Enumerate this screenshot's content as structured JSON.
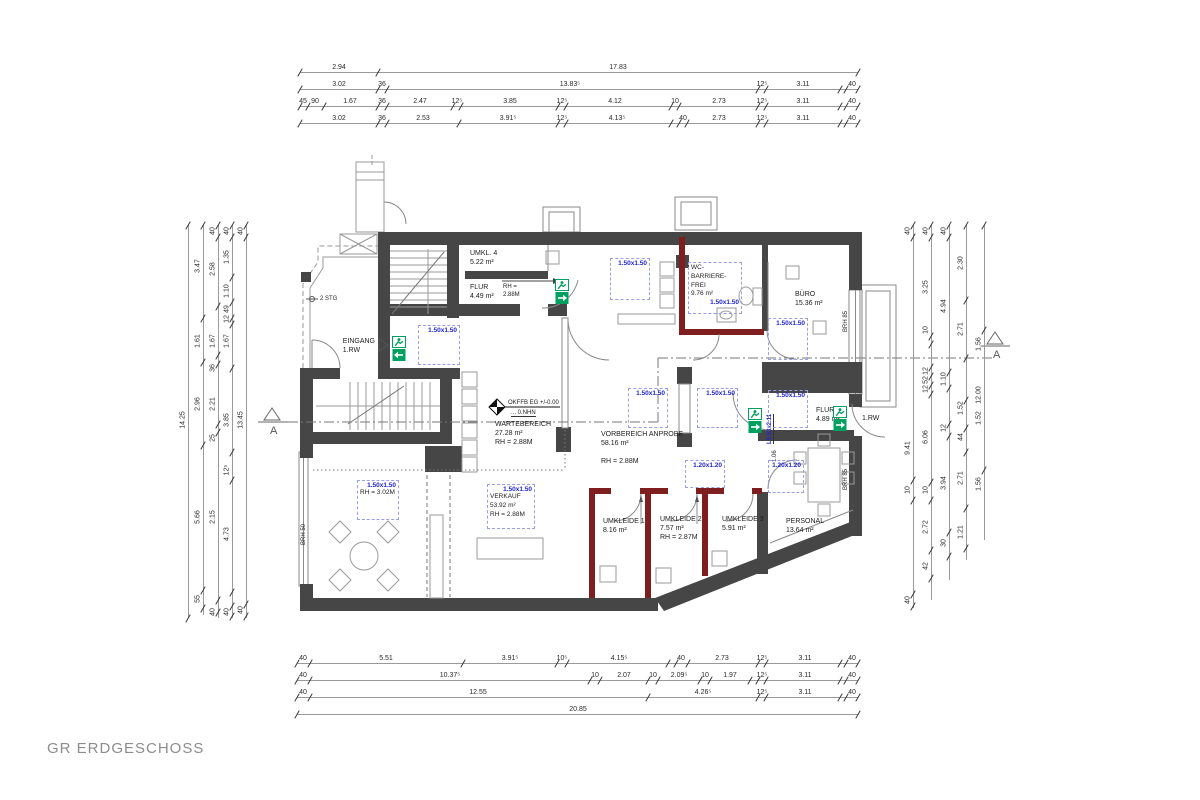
{
  "title": "GR ERDGESCHOSS",
  "colors": {
    "wall": "#464646",
    "red_wall": "#7e1e1e",
    "blue_label": "#2126cf",
    "blue_dash": "#9a9fe8",
    "exit_green": "#00a160",
    "line": "#999999"
  },
  "labels": [
    {
      "t": "UMKL. 4\n5.22 m²",
      "x": 470,
      "y": 249
    },
    {
      "t": "FLUR\n4.49 m²",
      "x": 470,
      "y": 283
    },
    {
      "t": "RH =\n2.88M",
      "x": 503,
      "y": 284,
      "cls": "small"
    },
    {
      "t": "EINGANG\n1.RW",
      "x": 375,
      "y": 337,
      "cls": "right"
    },
    {
      "t": "2 STG",
      "x": 320,
      "y": 296,
      "cls": "small"
    },
    {
      "t": "BÜRO\n15.36 m²",
      "x": 795,
      "y": 290
    },
    {
      "t": "WARTEBEREICH\n27.28 m²\nRH = 2.88M",
      "x": 495,
      "y": 420
    },
    {
      "t": "VORBEREICH ANPROBE\n58.16 m²\n\nRH = 2.88M",
      "x": 601,
      "y": 430
    },
    {
      "t": "FLUR\n4.89 m²",
      "x": 816,
      "y": 406
    },
    {
      "t": "1.RW",
      "x": 862,
      "y": 414
    },
    {
      "t": "UMKLEIDE 1\n8.16 m²",
      "x": 603,
      "y": 517
    },
    {
      "t": "UMKLEIDE 2\n7.57 m²\nRH = 2.87M",
      "x": 660,
      "y": 515
    },
    {
      "t": "UMKLEIDE 3\n5.91 m²",
      "x": 722,
      "y": 515
    },
    {
      "t": "PERSONAL\n13.64 m²",
      "x": 786,
      "y": 517
    },
    {
      "t": "OKFFB EG +/-0.00",
      "x": 508,
      "y": 400,
      "cls": "small"
    },
    {
      "t": "... 0.NHN",
      "x": 511,
      "y": 410,
      "cls": "small u"
    },
    {
      "t": "BRH 50",
      "x": 301,
      "y": 545,
      "cls": "small vert"
    },
    {
      "t": "BRH 85",
      "x": 843,
      "y": 332,
      "cls": "small vert"
    },
    {
      "t": "BRH 85",
      "x": 843,
      "y": 490,
      "cls": "small vert"
    },
    {
      "t": "1.06",
      "x": 772,
      "y": 462,
      "cls": "small vert"
    },
    {
      "t": "L0.93x2.11",
      "x": 767,
      "y": 444,
      "cls": "small vert blue"
    },
    {
      "t": "A",
      "x": 270,
      "y": 424,
      "cls": "marker"
    },
    {
      "t": "A",
      "x": 993,
      "y": 348,
      "cls": "marker"
    }
  ],
  "blue_boxes": [
    {
      "x": 418,
      "y": 325,
      "w": 42,
      "h": 40,
      "label": "1.50x1.50"
    },
    {
      "x": 610,
      "y": 258,
      "w": 40,
      "h": 42,
      "label": "1.50x1.50"
    },
    {
      "x": 688,
      "y": 262,
      "w": 54,
      "h": 52,
      "label": "1.50x1.50",
      "texts": [
        "WC-",
        "BARRIERE-",
        "FREI",
        "9.76 m²"
      ],
      "label_last": true
    },
    {
      "x": 768,
      "y": 318,
      "w": 40,
      "h": 42,
      "label": "1.50x1.50"
    },
    {
      "x": 628,
      "y": 388,
      "w": 40,
      "h": 40,
      "label": "1.50x1.50"
    },
    {
      "x": 697,
      "y": 388,
      "w": 41,
      "h": 40,
      "label": "1.50x1.50"
    },
    {
      "x": 768,
      "y": 390,
      "w": 40,
      "h": 38,
      "label": "1.50x1.50"
    },
    {
      "x": 357,
      "y": 480,
      "w": 42,
      "h": 40,
      "label": "1.50x1.50",
      "texts": [
        "RH = 3.02M"
      ]
    },
    {
      "x": 487,
      "y": 484,
      "w": 48,
      "h": 45,
      "label": "1.50x1.50",
      "texts": [
        "VERKAUF",
        "53.92 m²",
        "RH = 2.88M"
      ]
    },
    {
      "x": 685,
      "y": 460,
      "w": 40,
      "h": 28,
      "label": "1.20x1.20"
    },
    {
      "x": 768,
      "y": 460,
      "w": 36,
      "h": 33,
      "label": "1.20x1.20"
    }
  ],
  "exit_icons": [
    {
      "x": 392,
      "y": 336,
      "dir": "left"
    },
    {
      "x": 555,
      "y": 279,
      "dir": "right"
    },
    {
      "x": 748,
      "y": 408,
      "dir": "right"
    },
    {
      "x": 833,
      "y": 406,
      "dir": "right"
    }
  ],
  "dims": {
    "top": [
      {
        "y": 72,
        "x1": 300,
        "x2": 858,
        "ticks": [
          300,
          378,
          858
        ],
        "labels": [
          {
            "t": "2.94",
            "x": 339
          },
          {
            "t": "17.83",
            "x": 618
          }
        ]
      },
      {
        "y": 89,
        "x1": 300,
        "x2": 858,
        "ticks": [
          300,
          378,
          387,
          758,
          766,
          840,
          846,
          858
        ],
        "labels": [
          {
            "t": "3.02",
            "x": 339
          },
          {
            "t": "36",
            "x": 382
          },
          {
            "t": "13.83⁵",
            "x": 570
          },
          {
            "t": "12⁵",
            "x": 762
          },
          {
            "t": "3.11",
            "x": 803
          },
          {
            "t": "40",
            "x": 852
          }
        ]
      },
      {
        "y": 106,
        "x1": 300,
        "x2": 858,
        "ticks": [
          300,
          308,
          324,
          378,
          387,
          453,
          461,
          558,
          566,
          671,
          679,
          758,
          766,
          840,
          846,
          858
        ],
        "labels": [
          {
            "t": "45",
            "x": 303
          },
          {
            "t": "90",
            "x": 315
          },
          {
            "t": "1.67",
            "x": 350
          },
          {
            "t": "36",
            "x": 382
          },
          {
            "t": "2.47",
            "x": 420
          },
          {
            "t": "12⁵",
            "x": 457
          },
          {
            "t": "3.85",
            "x": 510
          },
          {
            "t": "12⁵",
            "x": 562
          },
          {
            "t": "4.12",
            "x": 615
          },
          {
            "t": "10",
            "x": 675
          },
          {
            "t": "2.73",
            "x": 719
          },
          {
            "t": "12⁵",
            "x": 762
          },
          {
            "t": "3.11",
            "x": 803
          },
          {
            "t": "40",
            "x": 852
          }
        ]
      },
      {
        "y": 123,
        "x1": 300,
        "x2": 858,
        "ticks": [
          300,
          378,
          387,
          459,
          558,
          566,
          671,
          679,
          687,
          758,
          766,
          840,
          846,
          858
        ],
        "labels": [
          {
            "t": "3.02",
            "x": 339
          },
          {
            "t": "36",
            "x": 382
          },
          {
            "t": "2.53",
            "x": 423
          },
          {
            "t": "3.91⁵",
            "x": 508
          },
          {
            "t": "12⁵",
            "x": 562
          },
          {
            "t": "4.13⁵",
            "x": 617
          },
          {
            "t": "40",
            "x": 683
          },
          {
            "t": "2.73",
            "x": 719
          },
          {
            "t": "12⁵",
            "x": 762
          },
          {
            "t": "3.11",
            "x": 803
          },
          {
            "t": "40",
            "x": 852
          }
        ]
      }
    ],
    "bottom": [
      {
        "y": 663,
        "x1": 297,
        "x2": 858,
        "ticks": [
          297,
          310,
          463,
          557,
          567,
          668,
          676,
          688,
          758,
          766,
          840,
          846,
          858
        ],
        "labels": [
          {
            "t": "40",
            "x": 303
          },
          {
            "t": "5.51",
            "x": 386
          },
          {
            "t": "3.91⁵",
            "x": 510
          },
          {
            "t": "10⁵",
            "x": 562
          },
          {
            "t": "4.15⁵",
            "x": 619
          },
          {
            "t": "40",
            "x": 681
          },
          {
            "t": "2.73",
            "x": 722
          },
          {
            "t": "12⁵",
            "x": 762
          },
          {
            "t": "3.11",
            "x": 805
          },
          {
            "t": "40",
            "x": 852
          }
        ]
      },
      {
        "y": 680,
        "x1": 297,
        "x2": 858,
        "ticks": [
          297,
          310,
          590,
          600,
          648,
          658,
          700,
          710,
          750,
          758,
          766,
          840,
          846,
          858
        ],
        "labels": [
          {
            "t": "40",
            "x": 303
          },
          {
            "t": "10.37⁵",
            "x": 450
          },
          {
            "t": "10",
            "x": 595
          },
          {
            "t": "2.07",
            "x": 624
          },
          {
            "t": "10",
            "x": 653
          },
          {
            "t": "2.09⁵",
            "x": 679
          },
          {
            "t": "10",
            "x": 705
          },
          {
            "t": "1.97",
            "x": 730
          },
          {
            "t": "12⁵",
            "x": 762
          },
          {
            "t": "3.11",
            "x": 805
          },
          {
            "t": "40",
            "x": 852
          }
        ]
      },
      {
        "y": 697,
        "x1": 297,
        "x2": 858,
        "ticks": [
          297,
          310,
          648,
          758,
          766,
          840,
          846,
          858
        ],
        "labels": [
          {
            "t": "40",
            "x": 303
          },
          {
            "t": "12.55",
            "x": 478
          },
          {
            "t": "4.26⁵",
            "x": 703
          },
          {
            "t": "12⁵",
            "x": 762
          },
          {
            "t": "3.11",
            "x": 805
          },
          {
            "t": "40",
            "x": 852
          }
        ]
      },
      {
        "y": 714,
        "x1": 297,
        "x2": 858,
        "ticks": [
          297,
          858
        ],
        "labels": [
          {
            "t": "20.85",
            "x": 578
          }
        ]
      }
    ],
    "left": [
      {
        "x": 188,
        "y1": 225,
        "y2": 618,
        "ticks": [
          225,
          618
        ],
        "labels": [
          {
            "t": "14.25",
            "y": 420
          }
        ]
      },
      {
        "x": 203,
        "y1": 225,
        "y2": 615,
        "ticks": [
          225,
          318,
          362,
          445,
          590,
          608
        ],
        "labels": [
          {
            "t": "3.47",
            "y": 266
          },
          {
            "t": "1.61",
            "y": 341
          },
          {
            "t": "2.96",
            "y": 404
          },
          {
            "t": "5.66",
            "y": 517
          },
          {
            "t": "55",
            "y": 599
          }
        ]
      },
      {
        "x": 218,
        "y1": 225,
        "y2": 618,
        "ticks": [
          225,
          237,
          306,
          355,
          364,
          424,
          432,
          600,
          612
        ],
        "labels": [
          {
            "t": "40",
            "y": 231
          },
          {
            "t": "2.58",
            "y": 269
          },
          {
            "t": "1.67",
            "y": 341
          },
          {
            "t": "36",
            "y": 368
          },
          {
            "t": "2.21",
            "y": 404
          },
          {
            "t": "25",
            "y": 438
          },
          {
            "t": "2.15",
            "y": 517
          },
          {
            "t": "40",
            "y": 612
          }
        ]
      },
      {
        "x": 232,
        "y1": 225,
        "y2": 618,
        "ticks": [
          225,
          237,
          277,
          302,
          318,
          324,
          368,
          452,
          480,
          592,
          606,
          616
        ],
        "labels": [
          {
            "t": "40",
            "y": 231
          },
          {
            "t": "1.35",
            "y": 257
          },
          {
            "t": "1.10",
            "y": 291
          },
          {
            "t": "49",
            "y": 309
          },
          {
            "t": "12",
            "y": 319
          },
          {
            "t": "1.67",
            "y": 341
          },
          {
            "t": "3.85",
            "y": 420
          },
          {
            "t": "12⁵",
            "y": 470
          },
          {
            "t": "4.73",
            "y": 534
          },
          {
            "t": "40",
            "y": 612
          }
        ]
      },
      {
        "x": 246,
        "y1": 225,
        "y2": 618,
        "ticks": [
          225,
          237,
          604,
          616
        ],
        "labels": [
          {
            "t": "40",
            "y": 231
          },
          {
            "t": "13.45",
            "y": 420
          },
          {
            "t": "40",
            "y": 610
          }
        ]
      }
    ],
    "right": [
      {
        "x": 913,
        "y1": 225,
        "y2": 608,
        "ticks": [
          225,
          237,
          480,
          500,
          594,
          606
        ],
        "labels": [
          {
            "t": "40",
            "y": 231
          },
          {
            "t": "9.41",
            "y": 448
          },
          {
            "t": "10",
            "y": 490
          },
          {
            "t": "40",
            "y": 600
          }
        ]
      },
      {
        "x": 931,
        "y1": 225,
        "y2": 600,
        "ticks": [
          225,
          237,
          336,
          344,
          367,
          376,
          385,
          394,
          482,
          500,
          550,
          578
        ],
        "labels": [
          {
            "t": "40",
            "y": 231
          },
          {
            "t": "3.25",
            "y": 287
          },
          {
            "t": "10",
            "y": 330
          },
          {
            "t": "12",
            "y": 371
          },
          {
            "t": "52",
            "y": 380
          },
          {
            "t": "12",
            "y": 389
          },
          {
            "t": "6.06",
            "y": 437
          },
          {
            "t": "10",
            "y": 490
          },
          {
            "t": "2.72",
            "y": 527
          },
          {
            "t": "42",
            "y": 566
          }
        ]
      },
      {
        "x": 949,
        "y1": 225,
        "y2": 580,
        "ticks": [
          225,
          237,
          372,
          388,
          424,
          436,
          532,
          556
        ],
        "labels": [
          {
            "t": "40",
            "y": 231
          },
          {
            "t": "4.94",
            "y": 306
          },
          {
            "t": "1.10",
            "y": 379
          },
          {
            "t": "12",
            "y": 428
          },
          {
            "t": "3.94",
            "y": 483
          },
          {
            "t": "30",
            "y": 543
          }
        ]
      },
      {
        "x": 966,
        "y1": 225,
        "y2": 560,
        "ticks": [
          225,
          300,
          358,
          400,
          428,
          452,
          508,
          548
        ],
        "labels": [
          {
            "t": "2.30",
            "y": 263
          },
          {
            "t": "2.71",
            "y": 329
          },
          {
            "t": "1.52",
            "y": 408
          },
          {
            "t": "44",
            "y": 437
          },
          {
            "t": "2.71",
            "y": 478
          },
          {
            "t": "1.21",
            "y": 532
          }
        ]
      },
      {
        "x": 984,
        "y1": 225,
        "y2": 540,
        "ticks": [
          225,
          330,
          470
        ],
        "labels": [
          {
            "t": "1.56",
            "y": 344
          },
          {
            "t": "12.00",
            "y": 395
          },
          {
            "t": "1.52",
            "y": 418
          },
          {
            "t": "1.56",
            "y": 484
          }
        ]
      }
    ]
  }
}
